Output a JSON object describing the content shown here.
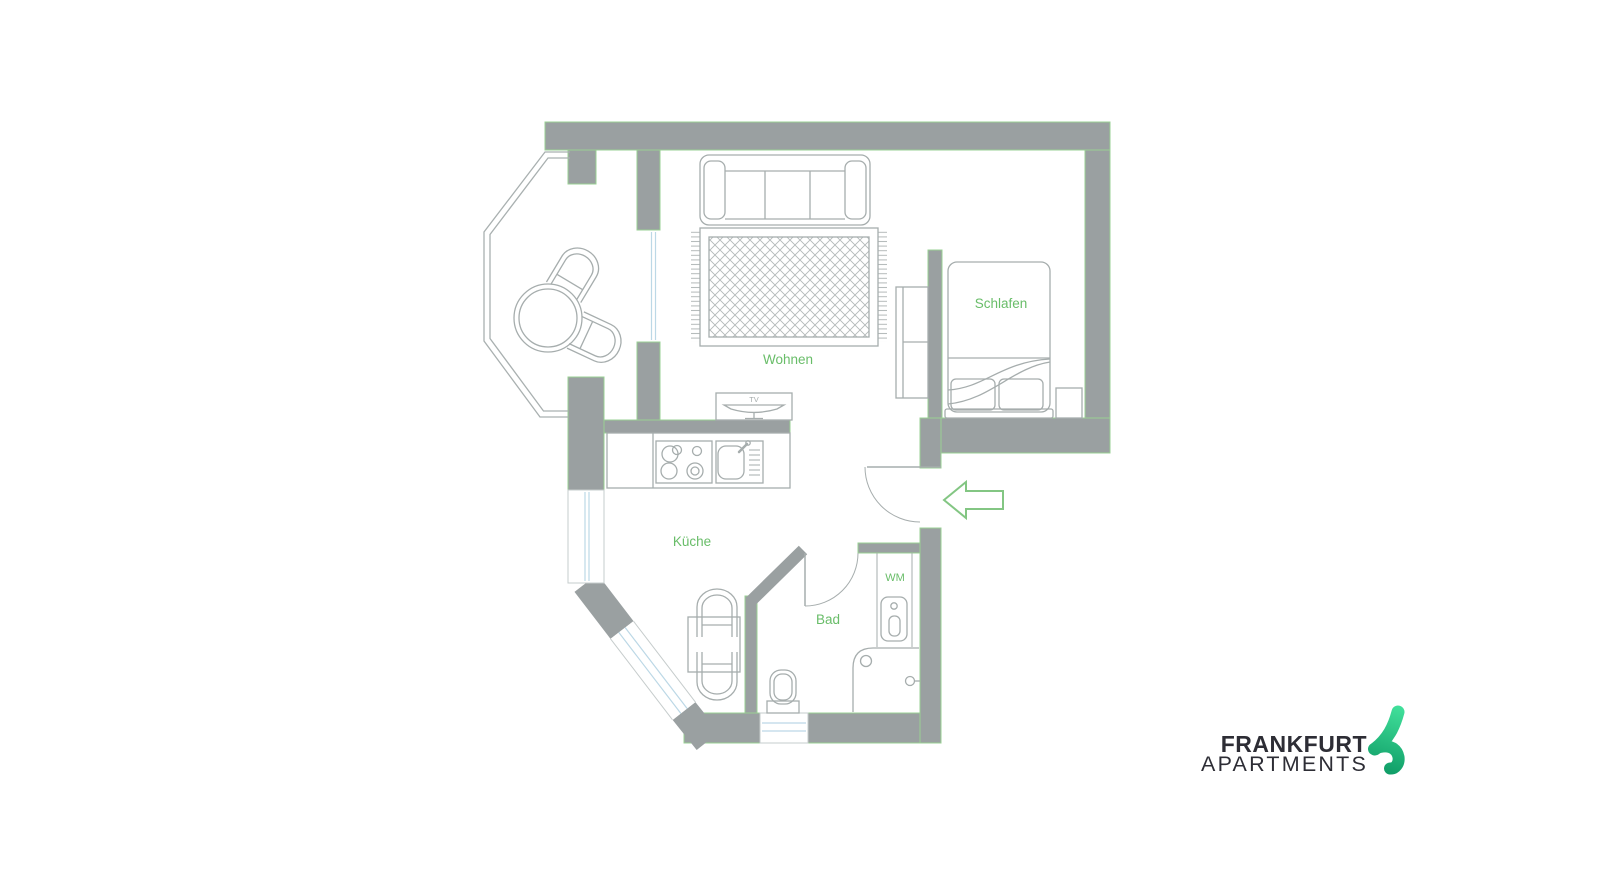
{
  "floor_plan": {
    "room_labels": {
      "living": "Wohnen",
      "bedroom": "Schlafen",
      "kitchen": "Küche",
      "bathroom": "Bad"
    },
    "fixture_labels": {
      "washing_machine": "WM",
      "tv": "TV"
    },
    "entrance": {
      "arrow_direction": "left"
    },
    "colors": {
      "wall": "#9aa0a1",
      "wall_outline": "#9ad094",
      "furniture_line": "#a6adad",
      "window_glass": "#bcd8e6",
      "label_green": "#69bd69",
      "arrow_green": "#83c683"
    }
  },
  "logo": {
    "name_line1": "FRANKFURT",
    "name_line2": "APARTMENTS",
    "text_color": "#2d2d35",
    "icon_green_light": "#41e09b",
    "icon_green_dark": "#0f9c66"
  }
}
